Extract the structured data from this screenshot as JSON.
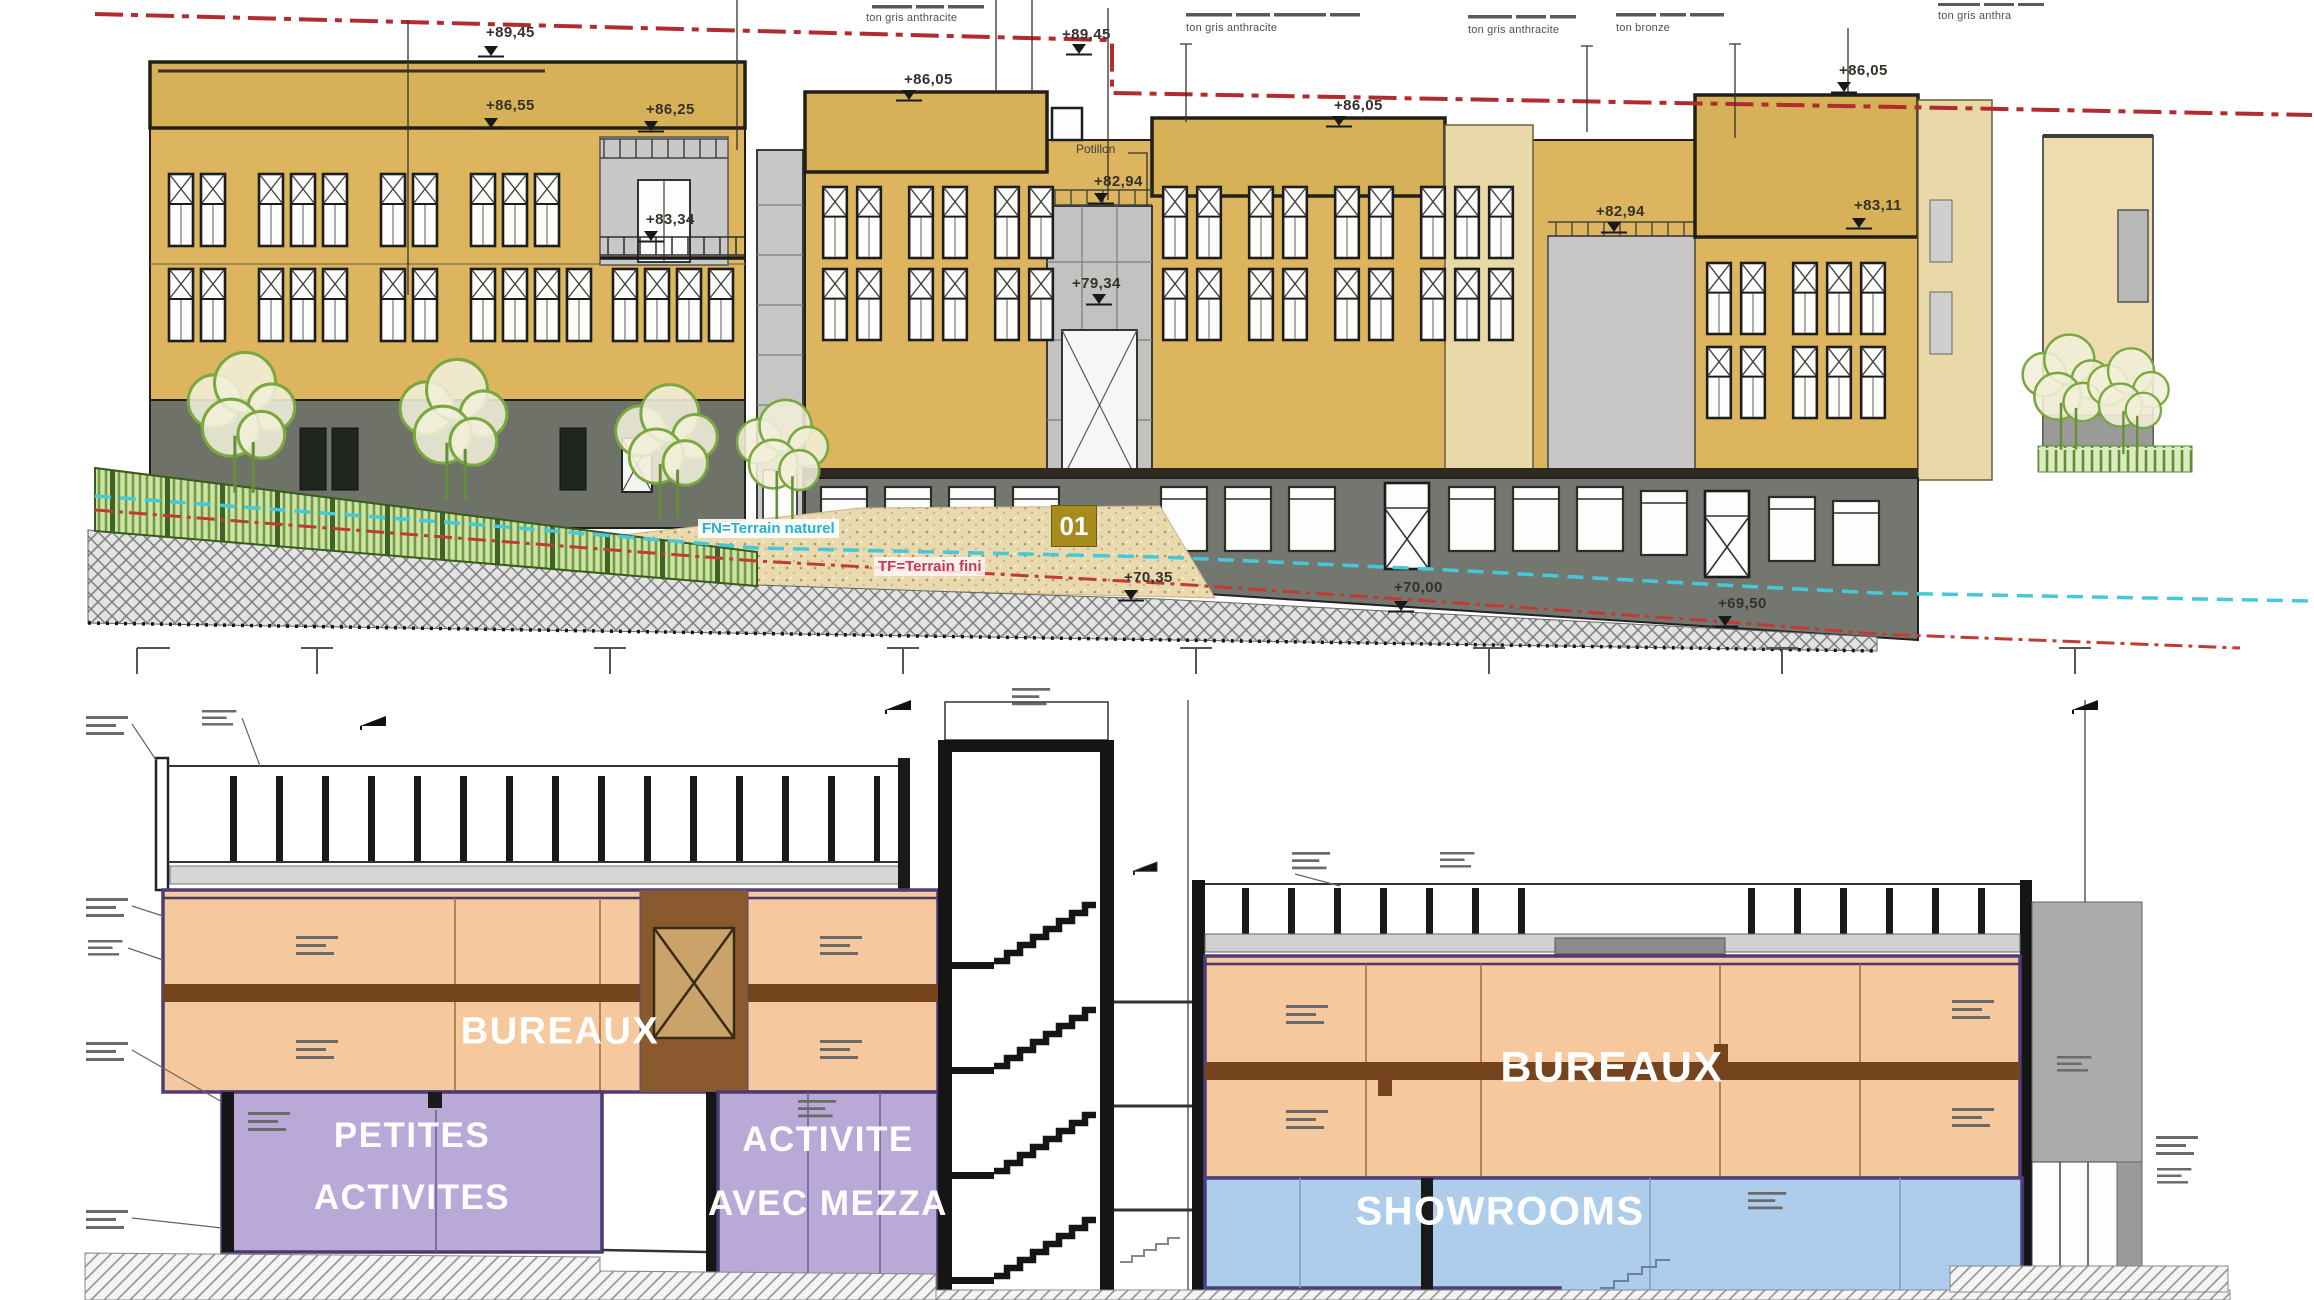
{
  "drawing": {
    "elevation": {
      "markers": [
        {
          "label": "+89,45"
        },
        {
          "label": "+89,45"
        },
        {
          "label": "+86,55"
        },
        {
          "label": "+86,25"
        },
        {
          "label": "+83,34"
        },
        {
          "label": "+86,05"
        },
        {
          "label": "+86,05"
        },
        {
          "label": "+86,05"
        },
        {
          "label": "+82,94"
        },
        {
          "label": "+82,94"
        },
        {
          "label": "+83,11"
        },
        {
          "label": "+79,34"
        },
        {
          "label": "+70,35"
        },
        {
          "label": "+70,00"
        },
        {
          "label": "+69,50"
        }
      ],
      "material_notes": [
        {
          "text": "ton gris anthracite"
        },
        {
          "text": "ton gris anthracite"
        },
        {
          "text": "ton gris anthracite"
        },
        {
          "text": "ton bronze"
        },
        {
          "text": "ton gris anthra"
        }
      ],
      "potillon_label": "Potillon",
      "terrain_natural": "FN=Terrain naturel",
      "terrain_finished": "TF=Terrain fini",
      "section_marker": "01"
    },
    "section": {
      "zones": {
        "bureaux_left": "BUREAUX",
        "bureaux_right": "BUREAUX",
        "petites_line1": "PETITES",
        "petites_line2": "ACTIVITES",
        "activite_line1": "ACTIVITE",
        "activite_line2": "AVEC ME22A",
        "showrooms": "SHOWROOMS"
      }
    }
  }
}
